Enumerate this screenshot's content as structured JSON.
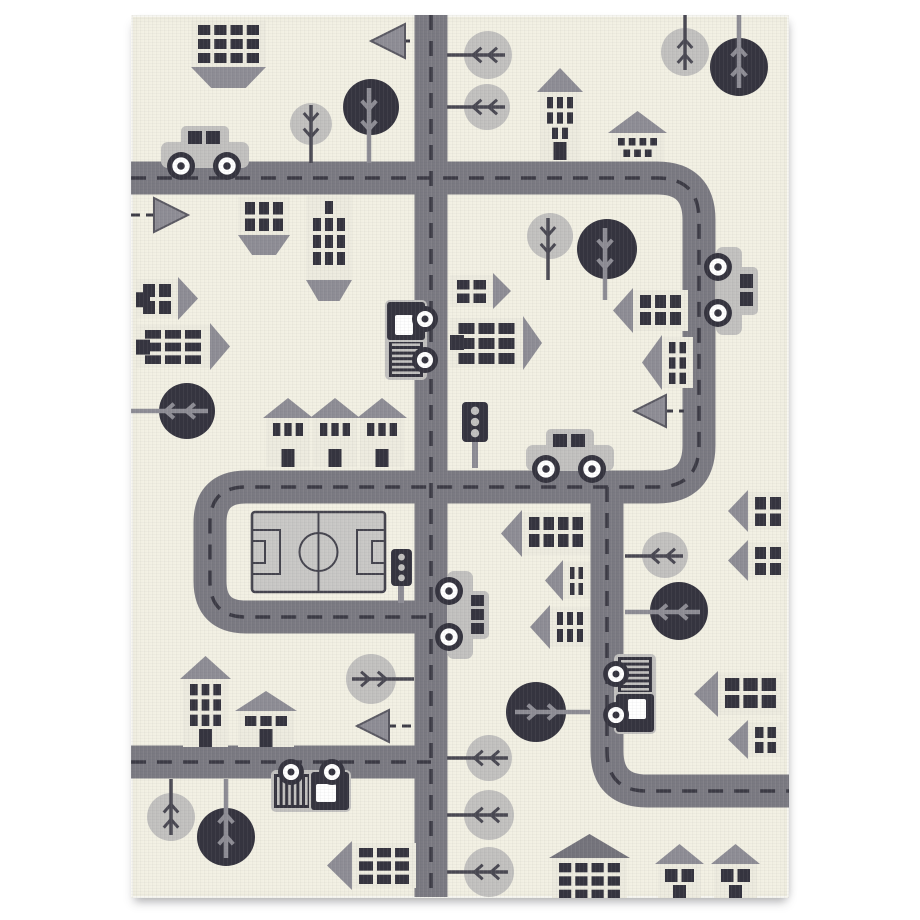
{
  "meta": {
    "description": "product photo of a children's city road play rug, cream background with gray roads, houses, trees, cars and a soccer field",
    "style": "woven knit carpet, grayscale palette on cream"
  },
  "canvas": {
    "w": 920,
    "h": 920,
    "bg": "#ffffff"
  },
  "rug": {
    "x": 131,
    "y": 15,
    "w": 658,
    "h": 883
  },
  "colors": {
    "rug_bg": "#f2f0e3",
    "road": "#7b7a82",
    "road_dash": "#3c3b45",
    "dark": "#35343f",
    "mid_gray": "#8e8d95",
    "mid_gray_edge": "#5a5962",
    "light_gray": "#c2c1bf",
    "house_body": "#edebdf",
    "roof_dark": "#75747c",
    "field_fill": "#c8c7c5",
    "field_line": "#45444e",
    "twig_dark": "#4a4953",
    "white": "#ffffff"
  },
  "roads": {
    "width": 33,
    "dash_width": 3.5,
    "dash_pattern": "15 11",
    "paths": [
      {
        "name": "top-right-loop",
        "d": "M131 178 H657 Q699 178 699 220 V445 Q699 487 657 487 H246 Q210 487 210 523 V581 Q210 617 246 617 H431"
      },
      {
        "name": "center-vertical",
        "d": "M431 15 V897"
      },
      {
        "name": "right-vertical-bottom",
        "d": "M607 487 V751 Q607 791 647 791 H789"
      },
      {
        "name": "bottom-left",
        "d": "M131 762 H431"
      }
    ]
  },
  "field": {
    "x": 252,
    "y": 512,
    "w": 133,
    "h": 80,
    "circle_r": 19,
    "penalty_w": 28,
    "penalty_h": 44,
    "goal_w": 13,
    "goal_h": 22
  },
  "trees": [
    {
      "c": [
        311,
        124
      ],
      "r": 21,
      "shade": "light",
      "stem": [
        [
          311,
          105
        ],
        [
          311,
          163
        ]
      ]
    },
    {
      "c": [
        371,
        107
      ],
      "r": 28,
      "shade": "dark",
      "stem": [
        [
          369,
          88
        ],
        [
          369,
          163
        ]
      ]
    },
    {
      "c": [
        488,
        55
      ],
      "r": 24,
      "shade": "light",
      "stem": [
        [
          505,
          55
        ],
        [
          447,
          55
        ]
      ]
    },
    {
      "c": [
        487,
        107
      ],
      "r": 23,
      "shade": "light",
      "stem": [
        [
          505,
          107
        ],
        [
          447,
          107
        ]
      ]
    },
    {
      "c": [
        685,
        52
      ],
      "r": 24,
      "shade": "light",
      "stem": [
        [
          685,
          70
        ],
        [
          685,
          15
        ]
      ]
    },
    {
      "c": [
        739,
        67
      ],
      "r": 29,
      "shade": "dark",
      "stem": [
        [
          739,
          88
        ],
        [
          739,
          15
        ]
      ]
    },
    {
      "c": [
        187,
        411
      ],
      "r": 28,
      "shade": "dark",
      "stem": [
        [
          208,
          411
        ],
        [
          131,
          411
        ]
      ]
    },
    {
      "c": [
        550,
        236
      ],
      "r": 23,
      "shade": "light",
      "stem": [
        [
          548,
          218
        ],
        [
          548,
          280
        ]
      ]
    },
    {
      "c": [
        607,
        249
      ],
      "r": 30,
      "shade": "dark",
      "stem": [
        [
          605,
          228
        ],
        [
          605,
          300
        ]
      ]
    },
    {
      "c": [
        665,
        555
      ],
      "r": 23,
      "shade": "light",
      "stem": [
        [
          683,
          556
        ],
        [
          625,
          556
        ]
      ]
    },
    {
      "c": [
        679,
        611
      ],
      "r": 29,
      "shade": "dark",
      "stem": [
        [
          700,
          612
        ],
        [
          625,
          612
        ]
      ]
    },
    {
      "c": [
        371,
        679
      ],
      "r": 25,
      "shade": "light",
      "stem": [
        [
          352,
          679
        ],
        [
          414,
          679
        ]
      ]
    },
    {
      "c": [
        489,
        758
      ],
      "r": 23,
      "shade": "light",
      "stem": [
        [
          508,
          758
        ],
        [
          447,
          758
        ]
      ]
    },
    {
      "c": [
        489,
        815
      ],
      "r": 25,
      "shade": "light",
      "stem": [
        [
          508,
          815
        ],
        [
          447,
          815
        ]
      ]
    },
    {
      "c": [
        489,
        872
      ],
      "r": 25,
      "shade": "light",
      "stem": [
        [
          508,
          872
        ],
        [
          447,
          872
        ]
      ]
    },
    {
      "c": [
        171,
        817
      ],
      "r": 24,
      "shade": "light",
      "stem": [
        [
          171,
          835
        ],
        [
          171,
          779
        ]
      ]
    },
    {
      "c": [
        226,
        837
      ],
      "r": 29,
      "shade": "dark",
      "stem": [
        [
          226,
          858
        ],
        [
          226,
          779
        ]
      ]
    },
    {
      "c": [
        536,
        712
      ],
      "r": 30,
      "shade": "dark",
      "stem": [
        [
          515,
          712
        ],
        [
          590,
          712
        ]
      ]
    }
  ],
  "arrows": [
    {
      "tip": [
        371,
        41
      ],
      "size": 34,
      "dir": "left",
      "line": [
        [
          371,
          41
        ],
        [
          416,
          41
        ]
      ]
    },
    {
      "tip": [
        188,
        215
      ],
      "size": 34,
      "dir": "right",
      "line": [
        [
          131,
          215
        ],
        [
          188,
          215
        ]
      ]
    },
    {
      "tip": [
        634,
        411
      ],
      "size": 32,
      "dir": "left",
      "line": [
        [
          634,
          411
        ],
        [
          684,
          411
        ]
      ]
    },
    {
      "tip": [
        357,
        726
      ],
      "size": 32,
      "dir": "left",
      "line": [
        [
          357,
          726
        ],
        [
          415,
          726
        ]
      ]
    }
  ],
  "traffic_lights": [
    {
      "box": [
        462,
        402,
        26,
        40
      ],
      "pole": [
        475,
        442,
        475,
        468
      ]
    },
    {
      "box": [
        391,
        549,
        21,
        37
      ],
      "pole": [
        401,
        586,
        401,
        603
      ]
    }
  ],
  "buildings": [
    {
      "type": "block",
      "body": [
        191,
        20,
        75,
        47
      ],
      "pattern": [
        4,
        4,
        4
      ],
      "trap": 21
    },
    {
      "type": "block",
      "body": [
        238,
        197,
        52,
        38
      ],
      "pattern": [
        3,
        3
      ],
      "trap": 20
    },
    {
      "type": "block",
      "body": [
        306,
        196,
        46,
        84
      ],
      "pattern": [
        1,
        3,
        3,
        3
      ],
      "trap": 21
    },
    {
      "type": "house-up",
      "body": [
        540,
        92,
        40,
        68
      ],
      "depth": 24,
      "pattern": [
        3,
        3,
        2
      ],
      "door": "bottom"
    },
    {
      "type": "house-up",
      "body": [
        611,
        133,
        53,
        28
      ],
      "depth": 22,
      "pattern": [
        4,
        3
      ]
    },
    {
      "type": "house-up",
      "body": [
        266,
        418,
        44,
        49
      ],
      "depth": 20,
      "pattern": [
        3
      ],
      "door": "bottom"
    },
    {
      "type": "house-up",
      "body": [
        313,
        418,
        44,
        49
      ],
      "depth": 20,
      "pattern": [
        3
      ],
      "door": "bottom"
    },
    {
      "type": "house-up",
      "body": [
        360,
        418,
        44,
        49
      ],
      "depth": 20,
      "pattern": [
        3
      ],
      "door": "bottom"
    },
    {
      "type": "house-up",
      "body": [
        183,
        679,
        45,
        68
      ],
      "depth": 23,
      "pattern": [
        3,
        3,
        3
      ],
      "door": "bottom"
    },
    {
      "type": "house-up",
      "body": [
        238,
        711,
        56,
        36
      ],
      "depth": 20,
      "pattern": [
        3
      ],
      "door": "bottom"
    },
    {
      "type": "house-up",
      "body": [
        552,
        858,
        75,
        45
      ],
      "depth": 24,
      "pattern": [
        4,
        4,
        4
      ],
      "roof": "dark"
    },
    {
      "type": "house-up",
      "body": [
        658,
        864,
        43,
        39
      ],
      "depth": 20,
      "pattern": [
        2
      ],
      "door": "bottom"
    },
    {
      "type": "house-up",
      "body": [
        714,
        864,
        43,
        39
      ],
      "depth": 20,
      "pattern": [
        2
      ],
      "door": "bottom"
    },
    {
      "type": "house-right",
      "body": [
        136,
        279,
        42,
        39
      ],
      "depth": 20,
      "pattern": [
        2,
        2
      ],
      "door": "left"
    },
    {
      "type": "house-right",
      "body": [
        136,
        325,
        74,
        43
      ],
      "depth": 20,
      "pattern": [
        3,
        3,
        3
      ],
      "door": "left"
    },
    {
      "type": "house-right",
      "body": [
        450,
        275,
        43,
        32
      ],
      "depth": 18,
      "pattern": [
        2,
        2
      ]
    },
    {
      "type": "house-right",
      "body": [
        450,
        318,
        73,
        50
      ],
      "depth": 19,
      "pattern": [
        3,
        3,
        3
      ],
      "door": "left"
    },
    {
      "type": "house-left",
      "body": [
        633,
        290,
        55,
        41
      ],
      "depth": 20,
      "pattern": [
        3,
        3
      ]
    },
    {
      "type": "house-left",
      "body": [
        662,
        337,
        31,
        51
      ],
      "depth": 20,
      "pattern": [
        2,
        2,
        2
      ]
    },
    {
      "type": "house-left",
      "body": [
        522,
        512,
        68,
        43
      ],
      "depth": 21,
      "pattern": [
        4,
        4
      ]
    },
    {
      "type": "house-left",
      "body": [
        563,
        562,
        27,
        37
      ],
      "depth": 18,
      "pattern": [
        2,
        2
      ]
    },
    {
      "type": "house-left",
      "body": [
        550,
        607,
        40,
        40
      ],
      "depth": 20,
      "pattern": [
        3,
        3
      ]
    },
    {
      "type": "house-left",
      "body": [
        748,
        492,
        40,
        38
      ],
      "depth": 20,
      "pattern": [
        2,
        2
      ]
    },
    {
      "type": "house-left",
      "body": [
        748,
        542,
        40,
        37
      ],
      "depth": 20,
      "pattern": [
        2,
        2
      ]
    },
    {
      "type": "house-left",
      "body": [
        718,
        673,
        65,
        42
      ],
      "depth": 24,
      "pattern": [
        3,
        3
      ]
    },
    {
      "type": "house-left",
      "body": [
        748,
        722,
        35,
        35
      ],
      "depth": 20,
      "pattern": [
        2,
        2
      ]
    },
    {
      "type": "house-left",
      "body": [
        352,
        843,
        64,
        45
      ],
      "depth": 25,
      "pattern": [
        3,
        3,
        3
      ]
    }
  ],
  "vehicles": [
    {
      "kind": "car",
      "cx": 205,
      "cy": 152,
      "angle": 0,
      "windows": 2
    },
    {
      "kind": "car",
      "cx": 570,
      "cy": 455,
      "angle": 0,
      "windows": 2
    },
    {
      "kind": "car",
      "cx": 732,
      "cy": 291,
      "angle": 90,
      "windows": 2
    },
    {
      "kind": "car",
      "cx": 463,
      "cy": 615,
      "angle": 90,
      "windows": 3
    },
    {
      "kind": "truck",
      "cx": 404,
      "cy": 340,
      "angle": -90,
      "flip": false
    },
    {
      "kind": "truck",
      "cx": 311,
      "cy": 793,
      "angle": 180,
      "flip": true
    },
    {
      "kind": "truck",
      "cx": 637,
      "cy": 694,
      "angle": 90,
      "flip": false
    }
  ]
}
